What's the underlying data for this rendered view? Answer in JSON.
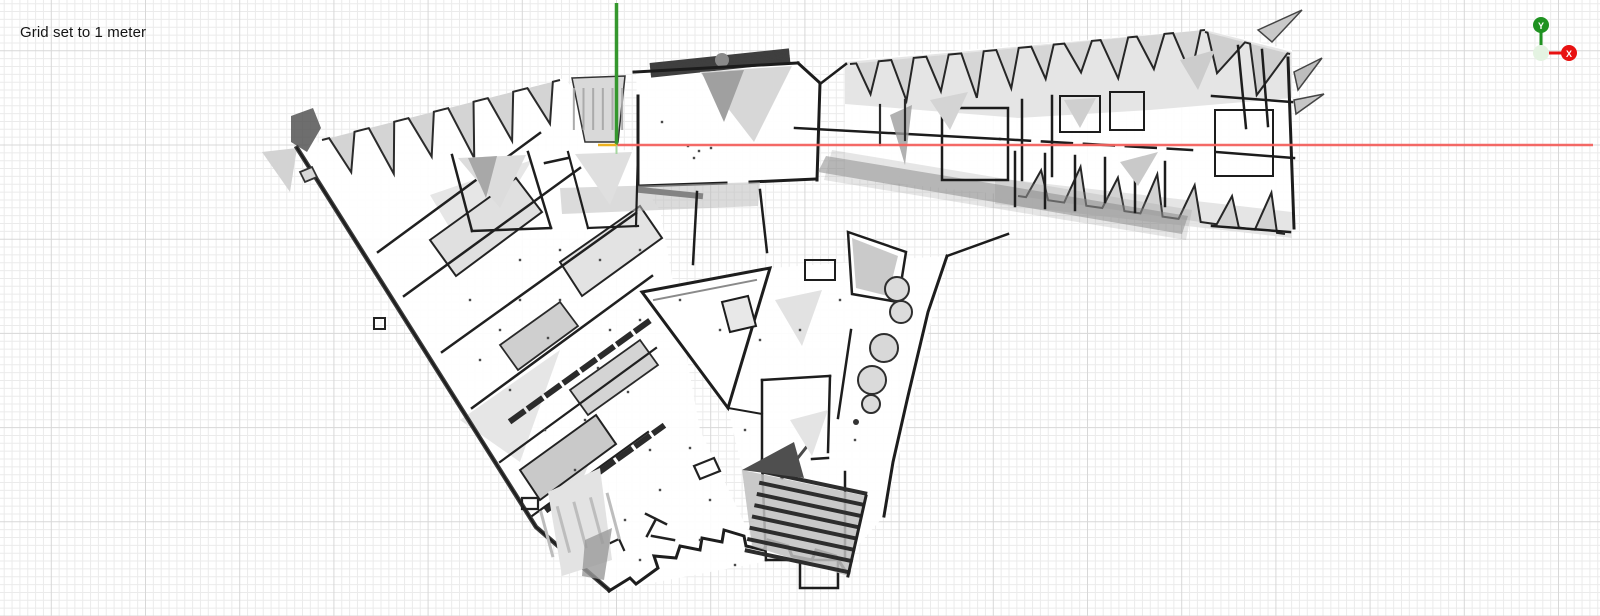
{
  "overlay": {
    "grid_label": "Grid set to 1 meter"
  },
  "gizmo": {
    "y_label": "Y",
    "x_label": "X",
    "y_color": "#1f9221",
    "x_color": "#e81111",
    "origin_fill": "#e4f3e2",
    "origin_stroke": "#2f8f2f"
  },
  "axes": {
    "origin_x": 616.5,
    "origin_y": 145,
    "x_end": 1593,
    "y_top": 3,
    "y_stub_end": 154,
    "x_color": "#f4625e",
    "y_color": "#35972e",
    "y_stub_color": "#a5d6a0",
    "tick_color": "#eeb220",
    "tick_x0": 598
  },
  "grid": {
    "minor_spacing": 7.85,
    "major_every": 12,
    "minor_color": "#ebebeb",
    "major_color": "#d8d8d8",
    "origin_x": 616.5,
    "origin_y": 145
  },
  "map": {
    "shapes": [
      {
        "t": "p",
        "d": "M297,148 L565,78 L660,210 L700,430 L763,562 L609,591 L536,527 Z",
        "f": "#ffffff",
        "o": 0.92
      },
      {
        "t": "p",
        "d": "M636,70 L800,62 L822,84 L818,180 L640,188 Z",
        "f": "#ffffff",
        "o": 0.95
      },
      {
        "t": "p",
        "d": "M845,60 L1205,30 L1292,50 L1292,235 L1018,196 L845,178 Z",
        "f": "#ffffff",
        "o": 0.92
      },
      {
        "t": "p",
        "d": "M642,292 L770,268 L947,256 L884,516 L845,560 L763,560 L728,408 Z",
        "f": "#ffffff",
        "o": 0.92
      },
      {
        "t": "p",
        "d": "M450,152 L640,150 L640,230 L470,232 Z",
        "f": "#ffffff",
        "o": 0.9
      },
      {
        "t": "p",
        "d": "M845,62 L1205,30 L1292,52 L1292,98 L1150,110 L1018,118 L845,104 Z",
        "f": "#e0e0e0",
        "o": 0.85
      },
      {
        "t": "p",
        "d": "M995,178 L1292,212 L1292,238 L995,204 Z",
        "f": "#dedede",
        "o": 0.8
      },
      {
        "t": "saw",
        "x0": 322,
        "y0": 140,
        "x1": 560,
        "y1": 80,
        "n": 6,
        "dp": 48,
        "f": "#d4d4d4",
        "s": "#2b2b2b",
        "w": 2
      },
      {
        "t": "p",
        "d": "M572,78 L625,76 L618,142 L585,142 Z",
        "f": "#d9d9d9",
        "s": "#333333",
        "w": 1.5
      },
      {
        "t": "h",
        "x": 577,
        "y": 80,
        "wd": 42,
        "ht": 58,
        "a": 90,
        "n": 6,
        "c": "#ababab",
        "lw": 2
      },
      {
        "t": "p",
        "d": "M262,152 L297,148 L290,192 Z",
        "f": "#d3d3d3"
      },
      {
        "t": "p",
        "d": "M291,116 l22,-8 l8,20 l-14,24 l-16,-10 Z",
        "f": "#555555",
        "o": 0.85
      },
      {
        "t": "p",
        "d": "M430,195 L532,160 L470,262 Z",
        "f": "#e6e6e6"
      },
      {
        "t": "p",
        "d": "M460,420 L560,350 L520,462 Z",
        "f": "#e6e6e6"
      },
      {
        "t": "p",
        "d": "M545,475 L602,432 L565,522 Z",
        "f": "#e2e2e2"
      },
      {
        "t": "p",
        "d": "M430,240 L516,178 L542,212 L456,276 Z",
        "f": "#e0e0e0",
        "s": "#232323",
        "w": 2
      },
      {
        "t": "p",
        "d": "M560,262 L640,206 L662,238 L582,296 Z",
        "f": "#e3e3e3",
        "s": "#232323",
        "w": 2
      },
      {
        "t": "p",
        "d": "M500,345 L560,302 L578,326 L518,370 Z",
        "f": "#cfcfcf",
        "s": "#2a2a2a",
        "w": 1.8
      },
      {
        "t": "p",
        "d": "M570,390 L640,340 L658,365 L588,415 Z",
        "f": "#d4d4d4",
        "s": "#2a2a2a",
        "w": 1.8
      },
      {
        "t": "p",
        "d": "M520,470 L596,415 L616,444 L540,500 Z",
        "f": "#c9c9c9",
        "s": "#222222",
        "w": 2
      },
      {
        "t": "p",
        "d": "M378,252 L540,133",
        "s": "#202020",
        "w": 2.5
      },
      {
        "t": "p",
        "d": "M404,296 L580,168",
        "s": "#202020",
        "w": 2.5
      },
      {
        "t": "p",
        "d": "M442,352 L636,213",
        "s": "#202020",
        "w": 2.5
      },
      {
        "t": "p",
        "d": "M472,408 L652,276",
        "s": "#202020",
        "w": 2.5
      },
      {
        "t": "p",
        "d": "M500,462 L656,348",
        "s": "#202020",
        "w": 2.2
      },
      {
        "t": "p",
        "d": "M532,516 L648,432",
        "s": "#202020",
        "w": 2.2
      },
      {
        "t": "p",
        "d": "M512,420 L648,322",
        "s": "#2b2b2b",
        "w": 6,
        "da": "13 9"
      },
      {
        "t": "p",
        "d": "M548,509 L662,427",
        "s": "#2b2b2b",
        "w": 6,
        "da": "13 9"
      },
      {
        "t": "p",
        "d": "M374,318 h11 v11 h-11 Z",
        "s": "#222222",
        "w": 2
      },
      {
        "t": "p",
        "d": "M297,148 L536,527 L609,590",
        "s": "#3c3c3c",
        "w": 4.5
      },
      {
        "t": "p",
        "d": "M297,148 L536,527 L609,590",
        "s": "#1b1b1b",
        "w": 1.8
      },
      {
        "t": "p",
        "d": "M609,591 L630,578 L636,584 L658,568 L654,556 L676,558 L680,546 L700,550 L702,538 L722,542 L724,530 L744,536 L746,546 L764,550 L768,540 L788,546 L792,556 L812,560 L816,550 L836,556 L846,572",
        "s": "#1d1d1d",
        "w": 3
      },
      {
        "t": "p",
        "d": "M522,498 h16 v11 h-16 Z",
        "s": "#222222",
        "w": 2.2
      },
      {
        "t": "p",
        "d": "M555,493 h10 v8 h-10 Z",
        "s": "#222222",
        "w": 2
      },
      {
        "t": "p",
        "d": "M646,514 l20,10 M656,519 l-9,17 M652,536 l22,4",
        "s": "#222222",
        "w": 2.5
      },
      {
        "t": "p",
        "d": "M694,466 l20,-8 l6,13 l-20,8 Z",
        "s": "#222222",
        "w": 2.2
      },
      {
        "t": "p",
        "d": "M604,546 l15,-7 l5,11",
        "s": "#222222",
        "w": 2.2
      },
      {
        "t": "p",
        "d": "M300,172 l12,-5 l5,10 l-12,5 Z",
        "s": "#333333",
        "w": 1.8,
        "f": "#d8d8d8"
      },
      {
        "t": "h",
        "x": 650,
        "y": 56,
        "wd": 140,
        "ht": 14,
        "a": -6,
        "n": 10,
        "c": "#3f3f3f",
        "lw": 2
      },
      {
        "t": "c",
        "cx": 722,
        "cy": 60,
        "r": 7,
        "f": "#8a8a8a"
      },
      {
        "t": "p",
        "d": "M700,72 L792,66 L754,142 Z",
        "f": "#d7d7d7"
      },
      {
        "t": "p",
        "d": "M702,73 L744,70 L724,122 Z",
        "f": "#a0a0a0"
      },
      {
        "t": "p",
        "d": "M638,188 L638,96",
        "s": "#1c1c1c",
        "w": 3
      },
      {
        "t": "p",
        "d": "M634,72 L798,63",
        "s": "#1c1c1c",
        "w": 3
      },
      {
        "t": "p",
        "d": "M798,63 L820,83 L817,180",
        "s": "#1c1c1c",
        "w": 3
      },
      {
        "t": "p",
        "d": "M640,186 L726,183",
        "s": "#1c1c1c",
        "w": 3
      },
      {
        "t": "p",
        "d": "M750,182 L817,179",
        "s": "#1c1c1c",
        "w": 3
      },
      {
        "t": "p",
        "d": "M640,190 L700,196",
        "s": "#3d3d3d",
        "w": 6
      },
      {
        "t": "p",
        "d": "M560,188 L760,182 L758,206 L562,214 Z",
        "f": "#bdbdbd",
        "o": 0.55
      },
      {
        "t": "p",
        "d": "M452,155 L472,231",
        "s": "#1e1e1e",
        "w": 2.5
      },
      {
        "t": "p",
        "d": "M528,152 L551,228",
        "s": "#1e1e1e",
        "w": 2.5
      },
      {
        "t": "p",
        "d": "M472,231 L551,228",
        "s": "#1e1e1e",
        "w": 2.5
      },
      {
        "t": "p",
        "d": "M458,158 L526,155 L500,208 Z",
        "f": "#dcdcdc"
      },
      {
        "t": "p",
        "d": "M468,158 L497,156 L486,198 Z",
        "f": "#a8a8a8"
      },
      {
        "t": "p",
        "d": "M568,152 L588,228",
        "s": "#1e1e1e",
        "w": 2.2
      },
      {
        "t": "p",
        "d": "M588,228 L638,226",
        "s": "#1e1e1e",
        "w": 2.2
      },
      {
        "t": "p",
        "d": "M638,150 L636,226",
        "s": "#1e1e1e",
        "w": 2.2
      },
      {
        "t": "p",
        "d": "M575,154 L632,152 L610,205 Z",
        "f": "#dfdfdf"
      },
      {
        "t": "p",
        "d": "M545,163 L568,158",
        "s": "#1e1e1e",
        "w": 2.5
      },
      {
        "t": "saw",
        "x0": 850,
        "y0": 64,
        "x1": 1060,
        "y1": 44,
        "n": 6,
        "dp": 40,
        "f": "#d6d6d6",
        "s": "#262626",
        "w": 2
      },
      {
        "t": "saw",
        "x0": 1060,
        "y0": 44,
        "x1": 1205,
        "y1": 30,
        "n": 4,
        "dp": 38,
        "f": "#d6d6d6",
        "s": "#262626",
        "w": 2
      },
      {
        "t": "saw",
        "x0": 1205,
        "y0": 32,
        "x1": 1290,
        "y1": 54,
        "n": 2,
        "dp": 46,
        "f": "#cfcfcf",
        "s": "#262626",
        "w": 2
      },
      {
        "t": "saw",
        "x0": 1018,
        "y0": 196,
        "x1": 1285,
        "y1": 234,
        "n": 7,
        "dp": -36,
        "f": "#d2d2d2",
        "s": "#262626",
        "w": 2
      },
      {
        "t": "p",
        "d": "M820,84 L846,64",
        "s": "#1d1d1d",
        "w": 2.5
      },
      {
        "t": "p",
        "d": "M795,128 L1000,139",
        "s": "#1c1c1c",
        "w": 2.5
      },
      {
        "t": "p",
        "d": "M1000,139 L1192,150",
        "s": "#1c1c1c",
        "w": 2.5,
        "da": "30 12"
      },
      {
        "t": "p",
        "d": "M826,156 L1188,216 L1182,234 L818,172 Z",
        "f": "#7f7f7f",
        "o": 0.5
      },
      {
        "t": "p",
        "d": "M832,150 L1192,210 L1186,240 L824,180 Z",
        "f": "#9b9b9b",
        "o": 0.25
      },
      {
        "t": "p",
        "d": "M942,108 h66 v72 h-66 Z",
        "s": "#1c1c1c",
        "w": 2.5
      },
      {
        "t": "p",
        "d": "M1022,100 L1022,180",
        "s": "#1c1c1c",
        "w": 2.5
      },
      {
        "t": "p",
        "d": "M1052,96 L1052,176",
        "s": "#1c1c1c",
        "w": 2.5
      },
      {
        "t": "p",
        "d": "M890,115 L912,105 L905,165 Z",
        "f": "#9d9d9d",
        "o": 0.8
      },
      {
        "t": "p",
        "d": "M880,105 L880,145",
        "s": "#2a2a2a",
        "w": 2.2
      },
      {
        "t": "p",
        "d": "M905,100 L905,140",
        "s": "#2a2a2a",
        "w": 2.2
      },
      {
        "t": "p",
        "d": "M1015,152 L1015,206",
        "s": "#1c1c1c",
        "w": 2.5
      },
      {
        "t": "p",
        "d": "M1045,154 L1045,208",
        "s": "#1c1c1c",
        "w": 2.5
      },
      {
        "t": "p",
        "d": "M1075,156 L1075,210",
        "s": "#1c1c1c",
        "w": 2.5
      },
      {
        "t": "p",
        "d": "M1105,158 L1105,202",
        "s": "#1c1c1c",
        "w": 2.5
      },
      {
        "t": "p",
        "d": "M1135,160 L1135,212",
        "s": "#1c1c1c",
        "w": 2.5
      },
      {
        "t": "p",
        "d": "M1165,162 L1165,206",
        "s": "#1c1c1c",
        "w": 2.5
      },
      {
        "t": "p",
        "d": "M1060,96 h40 v36 h-40 Z",
        "s": "#1c1c1c",
        "w": 2
      },
      {
        "t": "p",
        "d": "M1110,92 h34 v38 h-34 Z",
        "s": "#1c1c1c",
        "w": 2
      },
      {
        "t": "p",
        "d": "M1064,100 L1096,98 L1080,128 Z",
        "f": "#cfcfcf"
      },
      {
        "t": "p",
        "d": "M1120,162 L1158,152 L1138,186 Z",
        "f": "#c9c9c9"
      },
      {
        "t": "p",
        "d": "M930,100 L968,92 L950,130 Z",
        "f": "#d4d4d4"
      },
      {
        "t": "p",
        "d": "M1180,60 L1215,50 L1198,90 Z",
        "f": "#cccccc"
      },
      {
        "t": "p",
        "d": "M1238,46 L1246,128",
        "s": "#1c1c1c",
        "w": 2.5
      },
      {
        "t": "p",
        "d": "M1262,50 L1268,126",
        "s": "#1c1c1c",
        "w": 2.5
      },
      {
        "t": "p",
        "d": "M1288,58 L1294,228",
        "s": "#1c1c1c",
        "w": 3
      },
      {
        "t": "p",
        "d": "M1212,96 L1292,102",
        "s": "#1c1c1c",
        "w": 2.5
      },
      {
        "t": "p",
        "d": "M1216,152 L1294,158",
        "s": "#1c1c1c",
        "w": 2.5
      },
      {
        "t": "p",
        "d": "M1212,226 L1290,232",
        "s": "#1c1c1c",
        "w": 2.5
      },
      {
        "t": "p",
        "d": "M1215,110 h58 v66 h-58 Z",
        "s": "#1c1c1c",
        "w": 2
      },
      {
        "t": "p",
        "d": "M1294,72 L1322,58 L1298,90 Z",
        "f": "#bdbdbd",
        "s": "#444444",
        "w": 1.5
      },
      {
        "t": "p",
        "d": "M1294,100 L1324,94 L1296,114 Z",
        "f": "#c6c6c6",
        "s": "#444444",
        "w": 1.5
      },
      {
        "t": "p",
        "d": "M1258,30 L1302,10 L1272,42 Z",
        "f": "#c9c9c9",
        "s": "#444444",
        "w": 1.5
      },
      {
        "t": "p",
        "d": "M947,256 L1008,234",
        "s": "#1c1c1c",
        "w": 2.5
      },
      {
        "t": "p",
        "d": "M642,292 L770,268 L728,408 Z",
        "f": "#ffffff",
        "s": "#1d1d1d",
        "w": 3
      },
      {
        "t": "p",
        "d": "M654,300 L756,280",
        "s": "#8a8a8a",
        "w": 2
      },
      {
        "t": "p",
        "d": "M697,192 L693,264",
        "s": "#1d1d1d",
        "w": 2.5
      },
      {
        "t": "p",
        "d": "M760,190 L767,252",
        "s": "#1d1d1d",
        "w": 2.5
      },
      {
        "t": "p",
        "d": "M848,232 L906,252 L898,302 L852,294 Z",
        "f": "#ffffff",
        "s": "#1d1d1d",
        "w": 2.5
      },
      {
        "t": "p",
        "d": "M852,238 L898,256 L888,296 L856,288 Z",
        "f": "#b3b3b3",
        "o": 0.7
      },
      {
        "t": "p",
        "d": "M947,256 L928,312 L908,396 L893,462 L884,516",
        "s": "#1d1d1d",
        "w": 3
      },
      {
        "t": "p",
        "d": "M851,330 L838,418",
        "s": "#1d1d1d",
        "w": 2.5
      },
      {
        "t": "p",
        "d": "M762,380 L830,376",
        "s": "#1d1d1d",
        "w": 2.5
      },
      {
        "t": "p",
        "d": "M762,380 L762,462",
        "s": "#1d1d1d",
        "w": 2.5
      },
      {
        "t": "p",
        "d": "M830,376 L828,452",
        "s": "#1d1d1d",
        "w": 2.5
      },
      {
        "t": "p",
        "d": "M762,460 L794,459",
        "s": "#1d1d1d",
        "w": 2.5
      },
      {
        "t": "p",
        "d": "M812,459 L828,458",
        "s": "#1d1d1d",
        "w": 2.5
      },
      {
        "t": "p",
        "d": "M762,462 L766,560",
        "s": "#1d1d1d",
        "w": 2.5
      },
      {
        "t": "p",
        "d": "M766,560 L845,560",
        "s": "#1d1d1d",
        "w": 2.5
      },
      {
        "t": "p",
        "d": "M845,560 L845,472",
        "s": "#1d1d1d",
        "w": 2.5
      },
      {
        "t": "p",
        "d": "M800,560 L800,588 L838,588 L838,562",
        "s": "#1d1d1d",
        "w": 2.5
      },
      {
        "t": "p",
        "d": "M728,408 L762,414",
        "s": "#1d1d1d",
        "w": 2
      },
      {
        "t": "p",
        "d": "M782,478 L812,440",
        "s": "#4a4a4a",
        "w": 3
      },
      {
        "t": "p",
        "d": "M805,260 h30 v20 h-30 Z",
        "s": "#1d1d1d",
        "w": 2
      },
      {
        "t": "p",
        "d": "M722,302 l26,-6 l8,30 l-26,6 Z",
        "s": "#1d1d1d",
        "w": 2,
        "f": "#e8e8e8"
      },
      {
        "t": "p",
        "d": "M775,300 L822,290 L802,346 Z",
        "f": "#e2e2e2"
      },
      {
        "t": "p",
        "d": "M790,420 L828,410 L812,456 Z",
        "f": "#e4e4e4"
      },
      {
        "t": "c",
        "cx": 897,
        "cy": 289,
        "r": 12,
        "f": "#dcdcdc",
        "s": "#2e2e2e",
        "w": 2
      },
      {
        "t": "c",
        "cx": 901,
        "cy": 312,
        "r": 11,
        "f": "#dcdcdc",
        "s": "#2e2e2e",
        "w": 2
      },
      {
        "t": "c",
        "cx": 884,
        "cy": 348,
        "r": 14,
        "f": "#d8d8d8",
        "s": "#2e2e2e",
        "w": 2
      },
      {
        "t": "c",
        "cx": 872,
        "cy": 380,
        "r": 14,
        "f": "#dadada",
        "s": "#2e2e2e",
        "w": 2
      },
      {
        "t": "c",
        "cx": 871,
        "cy": 404,
        "r": 9,
        "f": "#dcdcdc",
        "s": "#2e2e2e",
        "w": 2
      },
      {
        "t": "c",
        "cx": 856,
        "cy": 422,
        "r": 3,
        "f": "#333333"
      },
      {
        "t": "p",
        "d": "M742,470 L866,496 L848,576 L752,546 Z",
        "f": "#bfbfbf",
        "o": 0.85
      },
      {
        "t": "h",
        "x": 752,
        "y": 476,
        "wd": 108,
        "ht": 92,
        "a": 12,
        "n": 8,
        "c": "#2d2d2d",
        "lw": 4
      },
      {
        "t": "p",
        "d": "M742,470 L794,442 L804,478 Z",
        "f": "#4f4f4f"
      },
      {
        "t": "p",
        "d": "M866,496 L848,576",
        "s": "#222222",
        "w": 3
      },
      {
        "t": "p",
        "d": "M548,492 L600,468 L612,560 L562,576 Z",
        "f": "#e3e3e3"
      },
      {
        "t": "h",
        "x": 556,
        "y": 482,
        "wd": 48,
        "ht": 86,
        "a": 75,
        "n": 5,
        "c": "#bdbdbd",
        "lw": 3
      },
      {
        "t": "p",
        "d": "M585,540 L612,528 L604,580 L582,576 Z",
        "f": "#9a9a9a",
        "o": 0.8
      },
      {
        "t": "d",
        "pts": [
          [
            520,
            300
          ],
          [
            548,
            338
          ],
          [
            500,
            330
          ],
          [
            470,
            300
          ],
          [
            560,
            300
          ],
          [
            610,
            330
          ],
          [
            640,
            320
          ],
          [
            598,
            368
          ],
          [
            628,
            392
          ],
          [
            585,
            420
          ],
          [
            650,
            450
          ],
          [
            690,
            448
          ],
          [
            660,
            490
          ],
          [
            710,
            500
          ],
          [
            625,
            520
          ],
          [
            700,
            540
          ],
          [
            745,
            430
          ],
          [
            760,
            340
          ],
          [
            800,
            330
          ],
          [
            680,
            300
          ],
          [
            720,
            330
          ],
          [
            640,
            250
          ],
          [
            600,
            260
          ],
          [
            560,
            250
          ],
          [
            520,
            260
          ],
          [
            480,
            360
          ],
          [
            510,
            390
          ],
          [
            545,
            430
          ],
          [
            575,
            470
          ],
          [
            688,
            146
          ],
          [
            699,
            151
          ],
          [
            711,
            148
          ],
          [
            694,
            158
          ],
          [
            662,
            122
          ],
          [
            840,
            300
          ],
          [
            735,
            565
          ],
          [
            640,
            560
          ],
          [
            855,
            440
          ]
        ],
        "sz": 2.4,
        "c": "#4a4a4a"
      }
    ]
  }
}
